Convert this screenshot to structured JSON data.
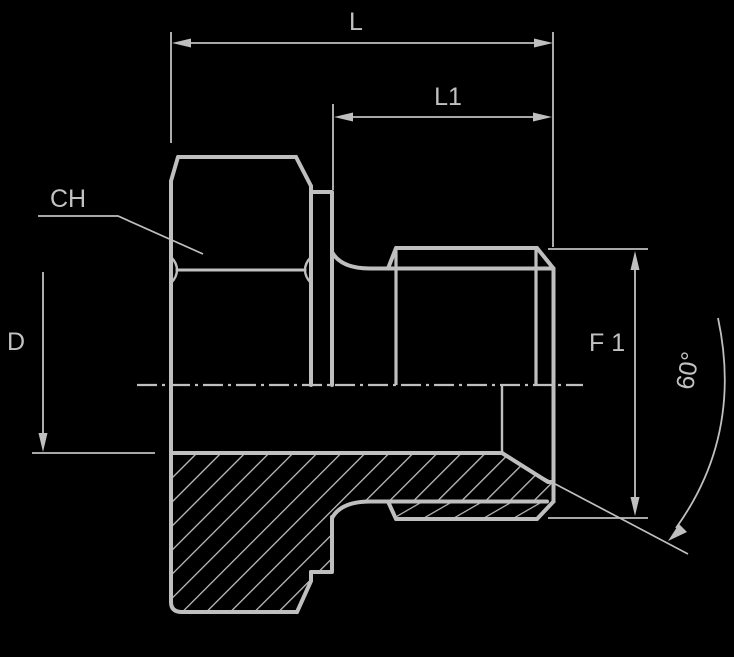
{
  "drawing": {
    "title": "Threaded plug fitting - sectioned technical drawing",
    "colors": {
      "background": "#000000",
      "line": "#bfbfbf",
      "text": "#c2c2c2"
    },
    "dimensions": {
      "overall_length": "L",
      "thread_length": "L1",
      "hex_wrench_size": "CH",
      "bore_diameter": "D",
      "thread_diameter": "F 1",
      "cone_angle": "60°"
    }
  }
}
